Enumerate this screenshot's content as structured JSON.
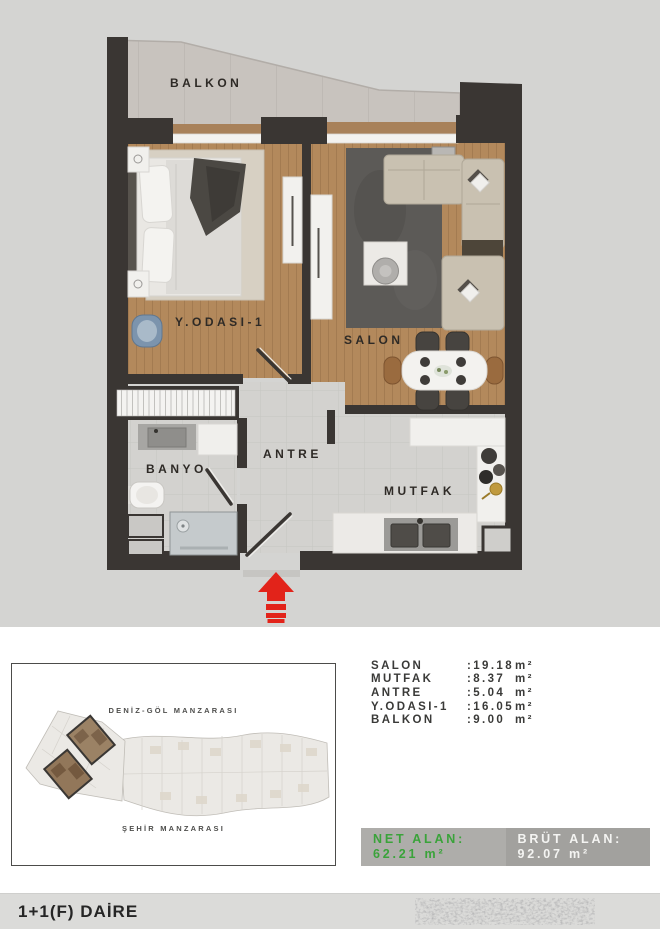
{
  "plan": {
    "rooms": {
      "balkon": "BALKON",
      "bedroom": "Y.ODASI-1",
      "salon": "SALON",
      "antre": "ANTRE",
      "banyo": "BANYO",
      "mutfak": "MUTFAK"
    },
    "entrance_arrow_color": "#e2231a"
  },
  "areas": {
    "rows": [
      {
        "label": "SALON",
        "value": ":19.18",
        "unit": "m²"
      },
      {
        "label": "MUTFAK",
        "value": ":8.37",
        "unit": "m²"
      },
      {
        "label": "ANTRE",
        "value": ":5.04",
        "unit": "m²"
      },
      {
        "label": "Y.ODASI-1",
        "value": ":16.05",
        "unit": "m²"
      },
      {
        "label": "BALKON",
        "value": ":9.00",
        "unit": "m²"
      }
    ]
  },
  "summary": {
    "net_label": "NET ALAN:",
    "net_value": "62.21 m²",
    "net_color": "#3aa33a",
    "brut_label": "BRÜT ALAN:",
    "brut_value": "92.07 m²",
    "brut_color": "#f4f4f2"
  },
  "sitemap": {
    "top_label": "DENİZ-GÖL MANZARASI",
    "bottom_label": "ŞEHİR MANZARASI"
  },
  "footer": {
    "title": "1+1(F) DAİRE"
  }
}
